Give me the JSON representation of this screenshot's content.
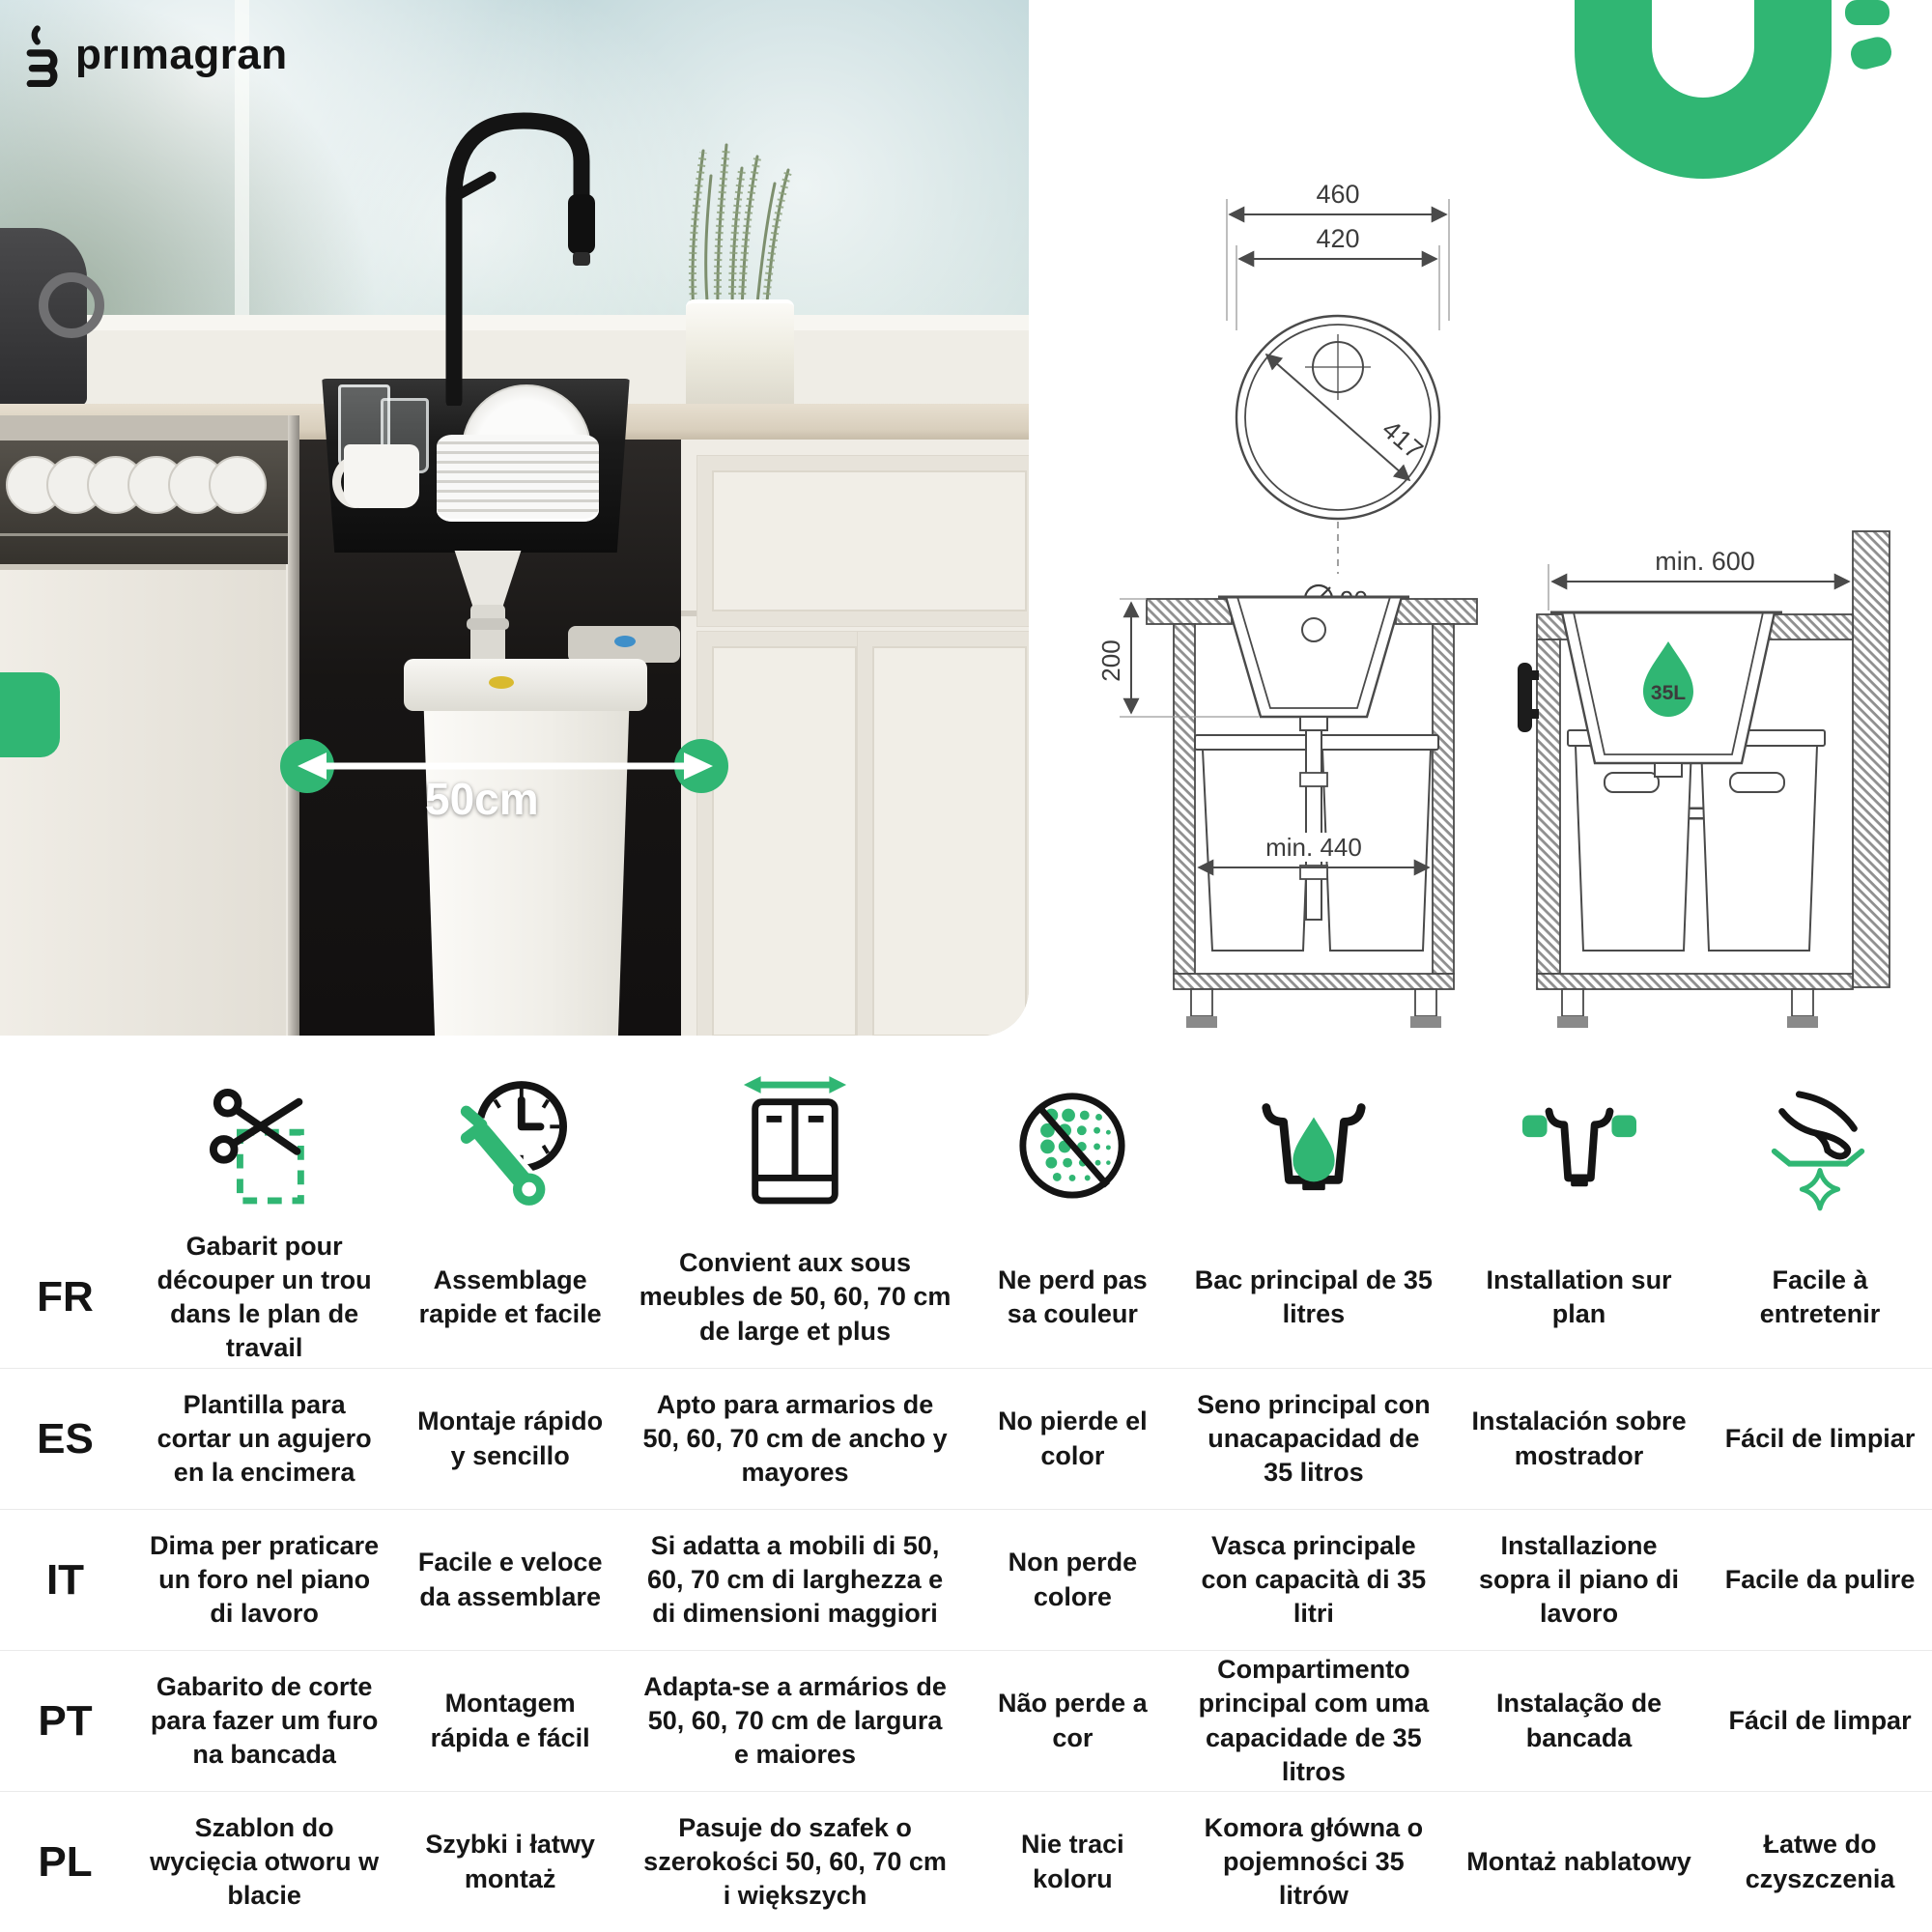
{
  "brand": {
    "name": "prımagran"
  },
  "colors": {
    "accent_green": "#30B673"
  },
  "photo": {
    "width_label": "50cm"
  },
  "diagram": {
    "top_view": {
      "outer_width": "460",
      "inner_width": "420",
      "bowl_diameter": "417",
      "drain_diameter": "90"
    },
    "front_section": {
      "depth": "200",
      "cabinet_min_width": "min. 440"
    },
    "side_section": {
      "cabinet_min_depth": "min. 600",
      "capacity_badge": "35L"
    }
  },
  "features": {
    "icons": [
      "cut-template-icon",
      "quick-assembly-icon",
      "cabinet-width-icon",
      "colorfast-icon",
      "bowl-capacity-icon",
      "top-mount-icon",
      "easy-clean-icon"
    ],
    "rows": [
      {
        "lang": "FR",
        "cells": [
          "Gabarit pour découper un trou dans le plan de travail",
          "Assemblage rapide et facile",
          "Convient aux sous  meubles de 50, 60, 70 cm  de large et plus",
          "Ne perd pas sa couleur",
          "Bac principal de 35 litres",
          "Installation sur plan",
          "Facile à entretenir"
        ]
      },
      {
        "lang": "ES",
        "cells": [
          "Plantilla para cortar un agujero en la encimera",
          "Montaje rápido y sencillo",
          "Apto para armarios  de 50, 60, 70 cm  de ancho y mayores",
          "No pierde el color",
          "Seno principal con unacapacidad de 35 litros",
          "Instalación sobre mostrador",
          "Fácil de limpiar"
        ]
      },
      {
        "lang": "IT",
        "cells": [
          "Dima per praticare un foro nel piano di lavoro",
          "Facile e veloce da assemblare",
          "Si adatta a mobili di 50, 60, 70 cm di larghezza e di dimensioni maggiori",
          "Non perde colore",
          "Vasca principale con capacità di 35 litri",
          "Installazione sopra il piano di lavoro",
          "Facile da pulire"
        ]
      },
      {
        "lang": "PT",
        "cells": [
          "Gabarito de corte para fazer um furo na bancada",
          "Montagem rápida e fácil",
          "Adapta-se a armários de 50, 60, 70 cm de largura e maiores",
          "Não perde a cor",
          "Compartimento principal com uma capacidade de 35 litros",
          "Instalação de bancada",
          "Fácil de limpar"
        ]
      },
      {
        "lang": "PL",
        "cells": [
          "Szablon do wycięcia otworu w blacie",
          "Szybki i łatwy montaż",
          "Pasuje do szafek o szerokości 50, 60, 70 cm i większych",
          "Nie traci koloru",
          "Komora główna o pojemności 35 litrów",
          "Montaż nablatowy",
          "Łatwe do czyszczenia"
        ]
      }
    ]
  }
}
